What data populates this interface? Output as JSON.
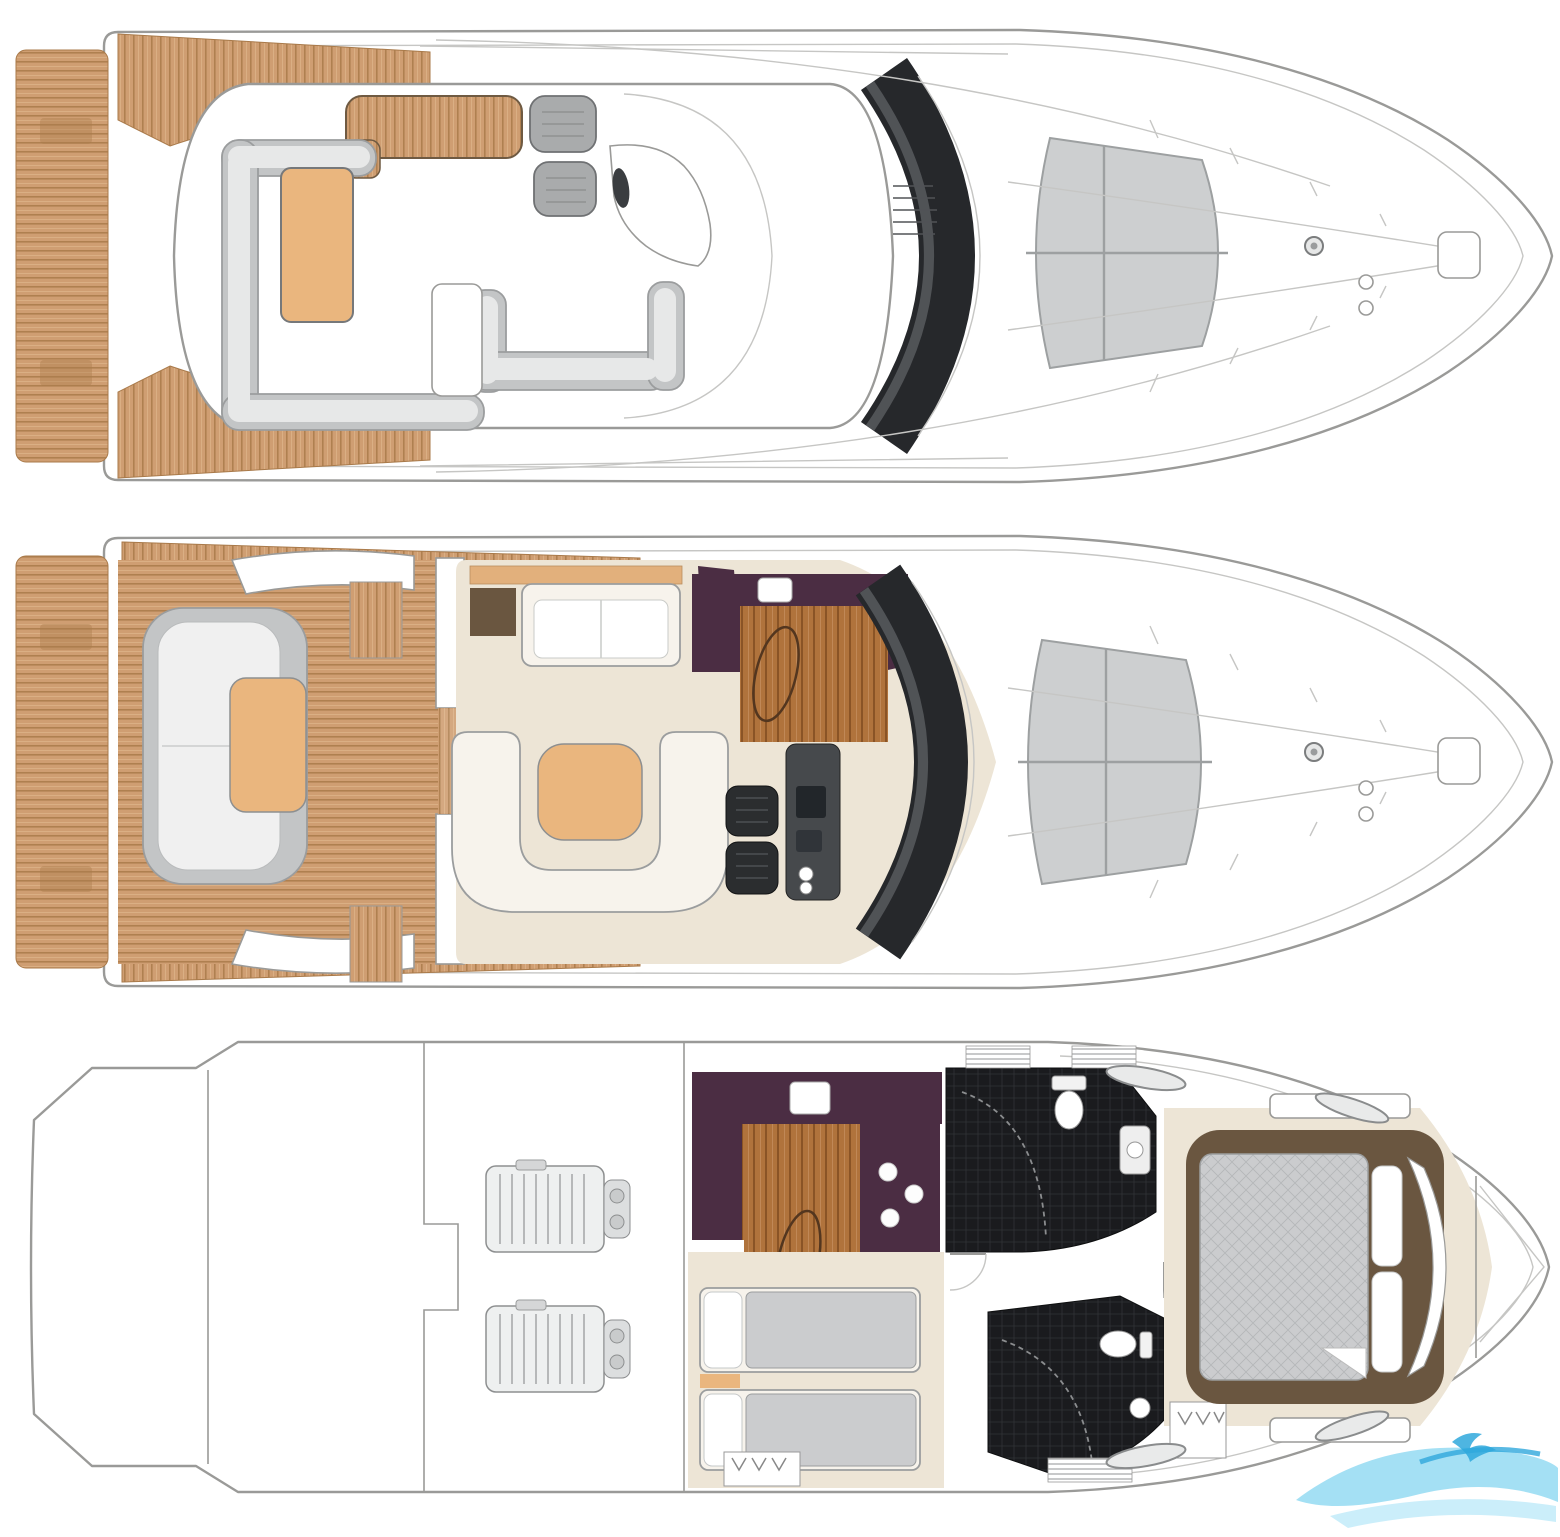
{
  "document": {
    "kind": "motor-yacht deck plan illustration",
    "views": [
      "flybridge-and-exterior",
      "main-deck",
      "lower-deck"
    ]
  },
  "palette": {
    "background": "#ffffff",
    "hull_line": "#9a9a98",
    "hull_faint": "#c6c6c4",
    "teak_base": "#cf9e72",
    "teak_line": "#a97a4a",
    "teak_light": "#e6c096",
    "wood_base": "#b0733c",
    "wood_line": "#8a5426",
    "seat_gray": "#c3c5c6",
    "seat_gray_border": "#8d8f90",
    "seat_inner": "#e7e8e8",
    "cushion_tan": "#eab67e",
    "sideboard_tan": "#e2b07c",
    "glass_dark": "#26282b",
    "glass_sheen": "#5b5e62",
    "sunpad_gray": "#cdcfd0",
    "sunpad_line": "#9da0a1",
    "aubergine": "#4b2d43",
    "cream_floor": "#ede5d6",
    "cream_furniture": "#f7f3ec",
    "walnut": "#6a5640",
    "tile_black": "#1a1b1e",
    "tile_line": "#303236",
    "bed_gray": "#cbccce",
    "quilt_line": "#b4b6b8",
    "pillow_white": "#ffffff",
    "engine_fill": "#eef0f0",
    "engine_line": "#8d8f90",
    "window_gray": "#e9eaea",
    "window_line": "#8a8c8d",
    "black_seat": "#2b2d2f",
    "console_gray": "#46494c",
    "watermark_blue": "#7ed3f0",
    "watermark_blue_light": "#b5e7f8",
    "watermark_blue_dark": "#2fa8dc"
  },
  "decks": [
    {
      "id": "flybridge-deck",
      "features": [
        "swim-platform",
        "aft-deck-steps",
        "flybridge-settee",
        "flybridge-table",
        "wet-bar-teak-top",
        "companion-bench",
        "helm-seat",
        "helm-console",
        "hardtop-windscreen",
        "foredeck-sunpad",
        "anchor-windlass",
        "bow-pulpit"
      ]
    },
    {
      "id": "main-deck",
      "features": [
        "swim-platform",
        "cockpit-teak",
        "cockpit-sunbed",
        "cockpit-seat",
        "flybridge-ladder",
        "saloon-sofa",
        "saloon-settee",
        "coffee-ottoman",
        "sideboard",
        "tv-cabinet",
        "galley-counter",
        "galley-hob",
        "galley-sink",
        "helm-seat",
        "helm-console",
        "windscreen",
        "foredeck-sunpad",
        "anchor-windlass"
      ]
    },
    {
      "id": "lower-deck",
      "features": [
        "transom-garage",
        "engine-room",
        "port-engine",
        "starboard-engine",
        "galley-counter",
        "galley-hob",
        "galley-sink",
        "dinette-table",
        "twin-cabin-bed",
        "wardrobe",
        "day-head",
        "ensuite-head",
        "shower-enclosure",
        "toilet",
        "washbasin",
        "master-cabin-bed",
        "master-headboard",
        "hull-window",
        "forward-bulkhead"
      ]
    }
  ],
  "watermark": {
    "icon": "wave-swoosh-logo"
  }
}
